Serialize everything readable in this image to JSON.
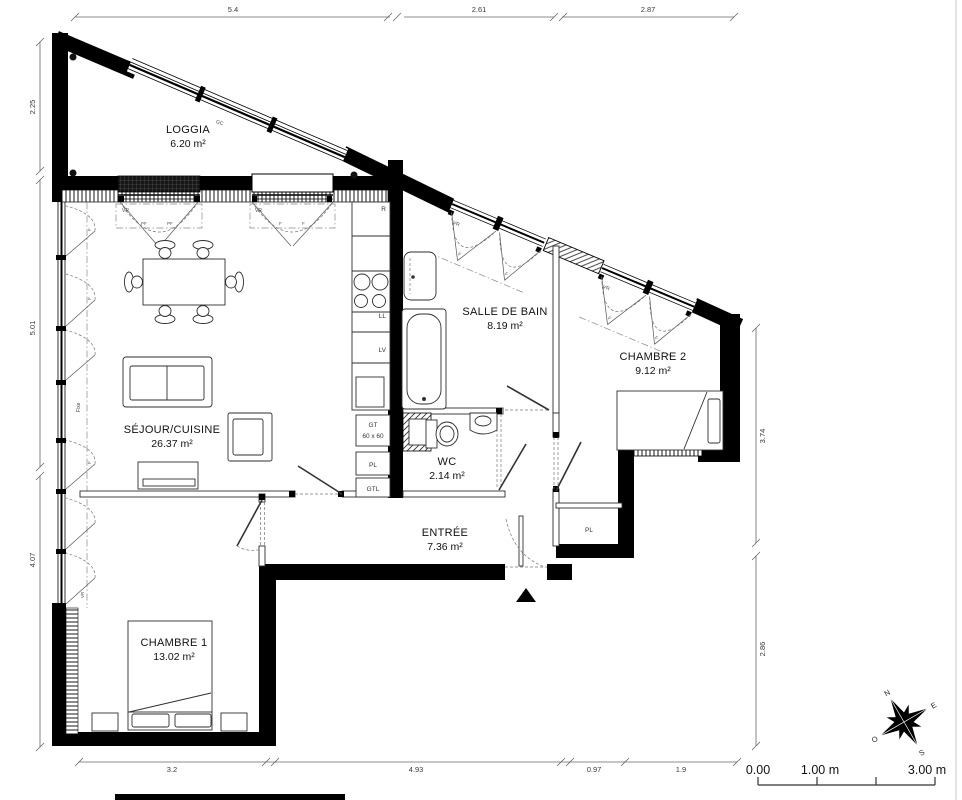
{
  "rooms": [
    {
      "name": "LOGGIA",
      "area": "6.20 m²"
    },
    {
      "name": "SÉJOUR/CUISINE",
      "area": "26.37 m²"
    },
    {
      "name": "SALLE DE BAIN",
      "area": "8.19 m²"
    },
    {
      "name": "CHAMBRE 2",
      "area": "9.12 m²"
    },
    {
      "name": "WC",
      "area": "2.14 m²"
    },
    {
      "name": "ENTRÉE",
      "area": "7.36 m²"
    },
    {
      "name": "CHAMBRE 1",
      "area": "13.02 m²"
    }
  ],
  "dimensions": {
    "top": [
      "5.4",
      "2.61",
      "2.87"
    ],
    "left": [
      "2.25",
      "5.01",
      "4.07"
    ],
    "right": [
      "3.74",
      "2.86"
    ],
    "bottom": [
      "3.2",
      "4.93",
      "0.97",
      "1.9"
    ]
  },
  "labels": {
    "gc": "GC",
    "fixe": "Fixe",
    "vr": "VR",
    "pf": "PF",
    "f": "F",
    "r": "R",
    "ll": "LL",
    "lv": "LV",
    "gt": "GT",
    "gt_size": "60 x 60",
    "pl": "PL",
    "gtl": "GTL"
  },
  "scale_bar": {
    "zero": "0.00",
    "one": "1.00 m",
    "three": "3.00 m"
  },
  "compass": {
    "n": "N",
    "e": "E",
    "s": "S",
    "o": "O"
  }
}
